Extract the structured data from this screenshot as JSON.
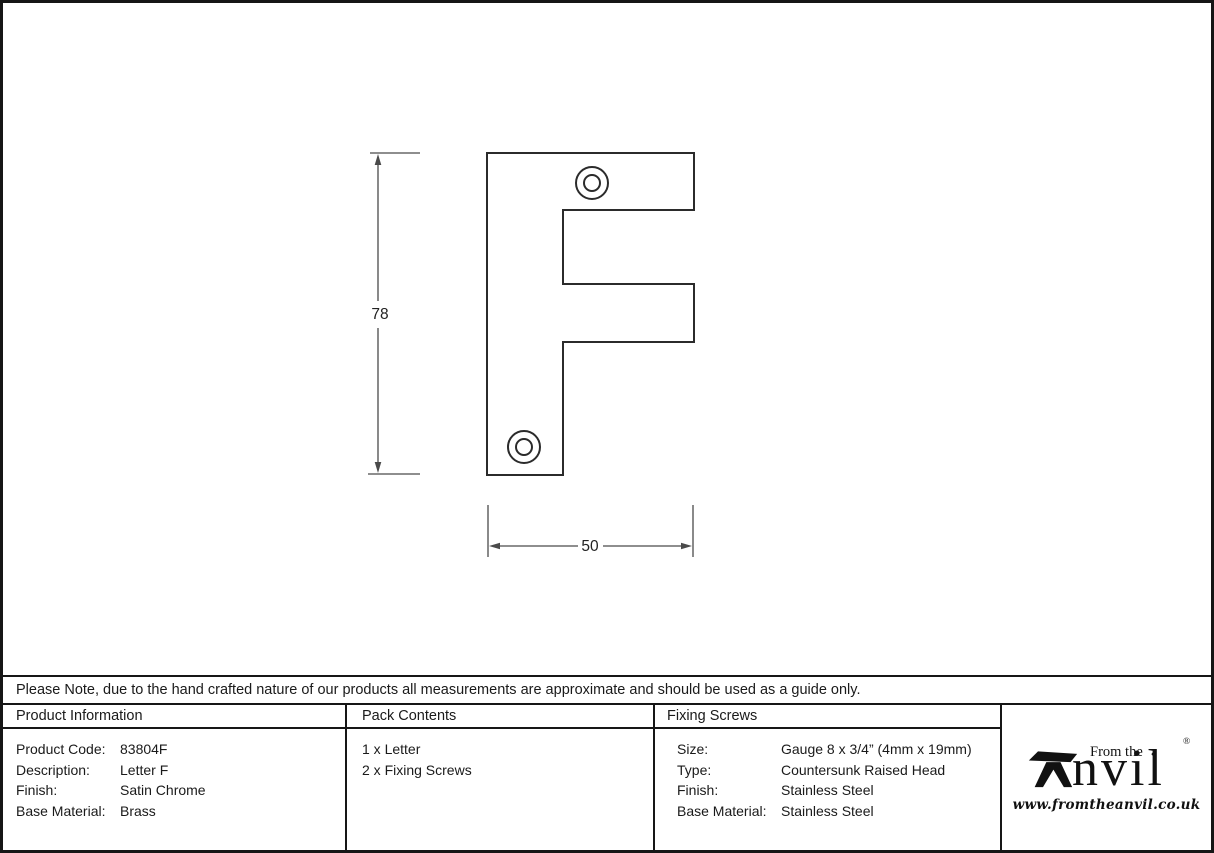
{
  "note": "Please Note, due to the hand crafted nature of our products all measurements are approximate and should be used as a guide only.",
  "drawing": {
    "subject": "Letter F outline with two screw holes",
    "height_label": "78",
    "width_label": "50"
  },
  "table": {
    "product_information": {
      "header": "Product Information",
      "rows": [
        {
          "label": "Product Code:",
          "value": "83804F"
        },
        {
          "label": "Description:",
          "value": "Letter F"
        },
        {
          "label": "Finish:",
          "value": "Satin Chrome"
        },
        {
          "label": "Base Material:",
          "value": "Brass"
        }
      ]
    },
    "pack_contents": {
      "header": "Pack Contents",
      "items": [
        "1 x Letter",
        "2 x Fixing Screws"
      ]
    },
    "fixing_screws": {
      "header": "Fixing Screws",
      "rows": [
        {
          "label": "Size:",
          "value": "Gauge 8 x 3/4” (4mm x 19mm)"
        },
        {
          "label": "Type:",
          "value": "Countersunk Raised Head"
        },
        {
          "label": "Finish:",
          "value": "Stainless Steel"
        },
        {
          "label": "Base Material:",
          "value": "Stainless Steel"
        }
      ]
    }
  },
  "brand": {
    "prefix": "From the",
    "diamond": "♦",
    "name_rest": "nvil",
    "registered": "®",
    "url": "www.fromtheanvil.co.uk"
  },
  "colors": {
    "outline": "#2b2b2b",
    "dimension": "#4a4a4a",
    "border": "#161616"
  }
}
